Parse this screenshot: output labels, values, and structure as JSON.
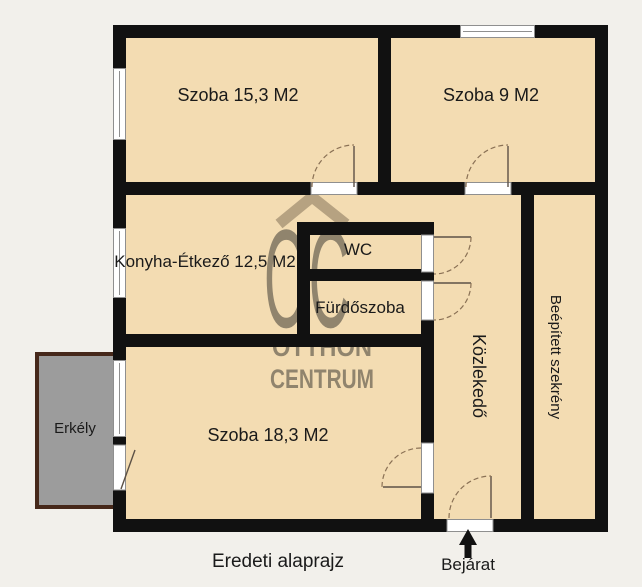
{
  "page": {
    "caption": "Eredeti alaprajz"
  },
  "plan": {
    "rooms": {
      "szoba_153": "Szoba 15,3 M2",
      "szoba_9": "Szoba 9 M2",
      "konyha": "Konyha-Étkező 12,5 M2",
      "wc": "WC",
      "furdoszoba": "Fürdőszoba",
      "kozlekedo": "Közlekedő",
      "szekreny": "Beépített szekrény",
      "szoba_183": "Szoba 18,3 M2",
      "erkely": "Erkély"
    },
    "entrance": "Bejárat"
  },
  "watermark": {
    "logo": "OC",
    "line1": "OTTHON",
    "line2": "CENTRUM"
  },
  "colors": {
    "background": "#f2f0eb",
    "floor": "#f3dcb2",
    "wall": "#111111",
    "balcony_fill": "#9c9c9c",
    "balcony_border": "#46281a",
    "window_fill": "#ffffff",
    "window_frame": "#8f8f8f",
    "door_swing": "#8a7155",
    "watermark": "#6d5c47",
    "text": "#1a1a1a"
  }
}
